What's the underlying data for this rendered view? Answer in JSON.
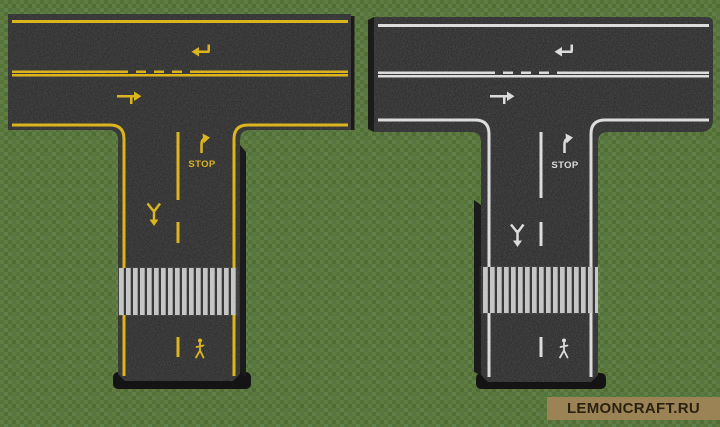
{
  "scene": {
    "type": "minecraft-screenshot",
    "description": "Two T-shaped asphalt road intersection builds on a grass field; left road has yellow markings, right road has white markings",
    "colors": {
      "grass": "#5a7a3d",
      "asphalt": "#272727",
      "asphalt_side": "#161616",
      "yellow_marking": "#dcb51e",
      "white_marking": "#dcdcdc",
      "crosswalk_stripe": "#c6c6c6"
    }
  },
  "roads": [
    {
      "name": "yellow-marked-t-road",
      "marking_color": "#dcb51e",
      "stop_label": "STOP"
    },
    {
      "name": "white-marked-t-road",
      "marking_color": "#dcdcdc",
      "stop_label": "STOP"
    }
  ],
  "watermark": {
    "text": "LEMONCRAFT.RU",
    "background": "#9c8355",
    "text_color": "#2b2110"
  }
}
